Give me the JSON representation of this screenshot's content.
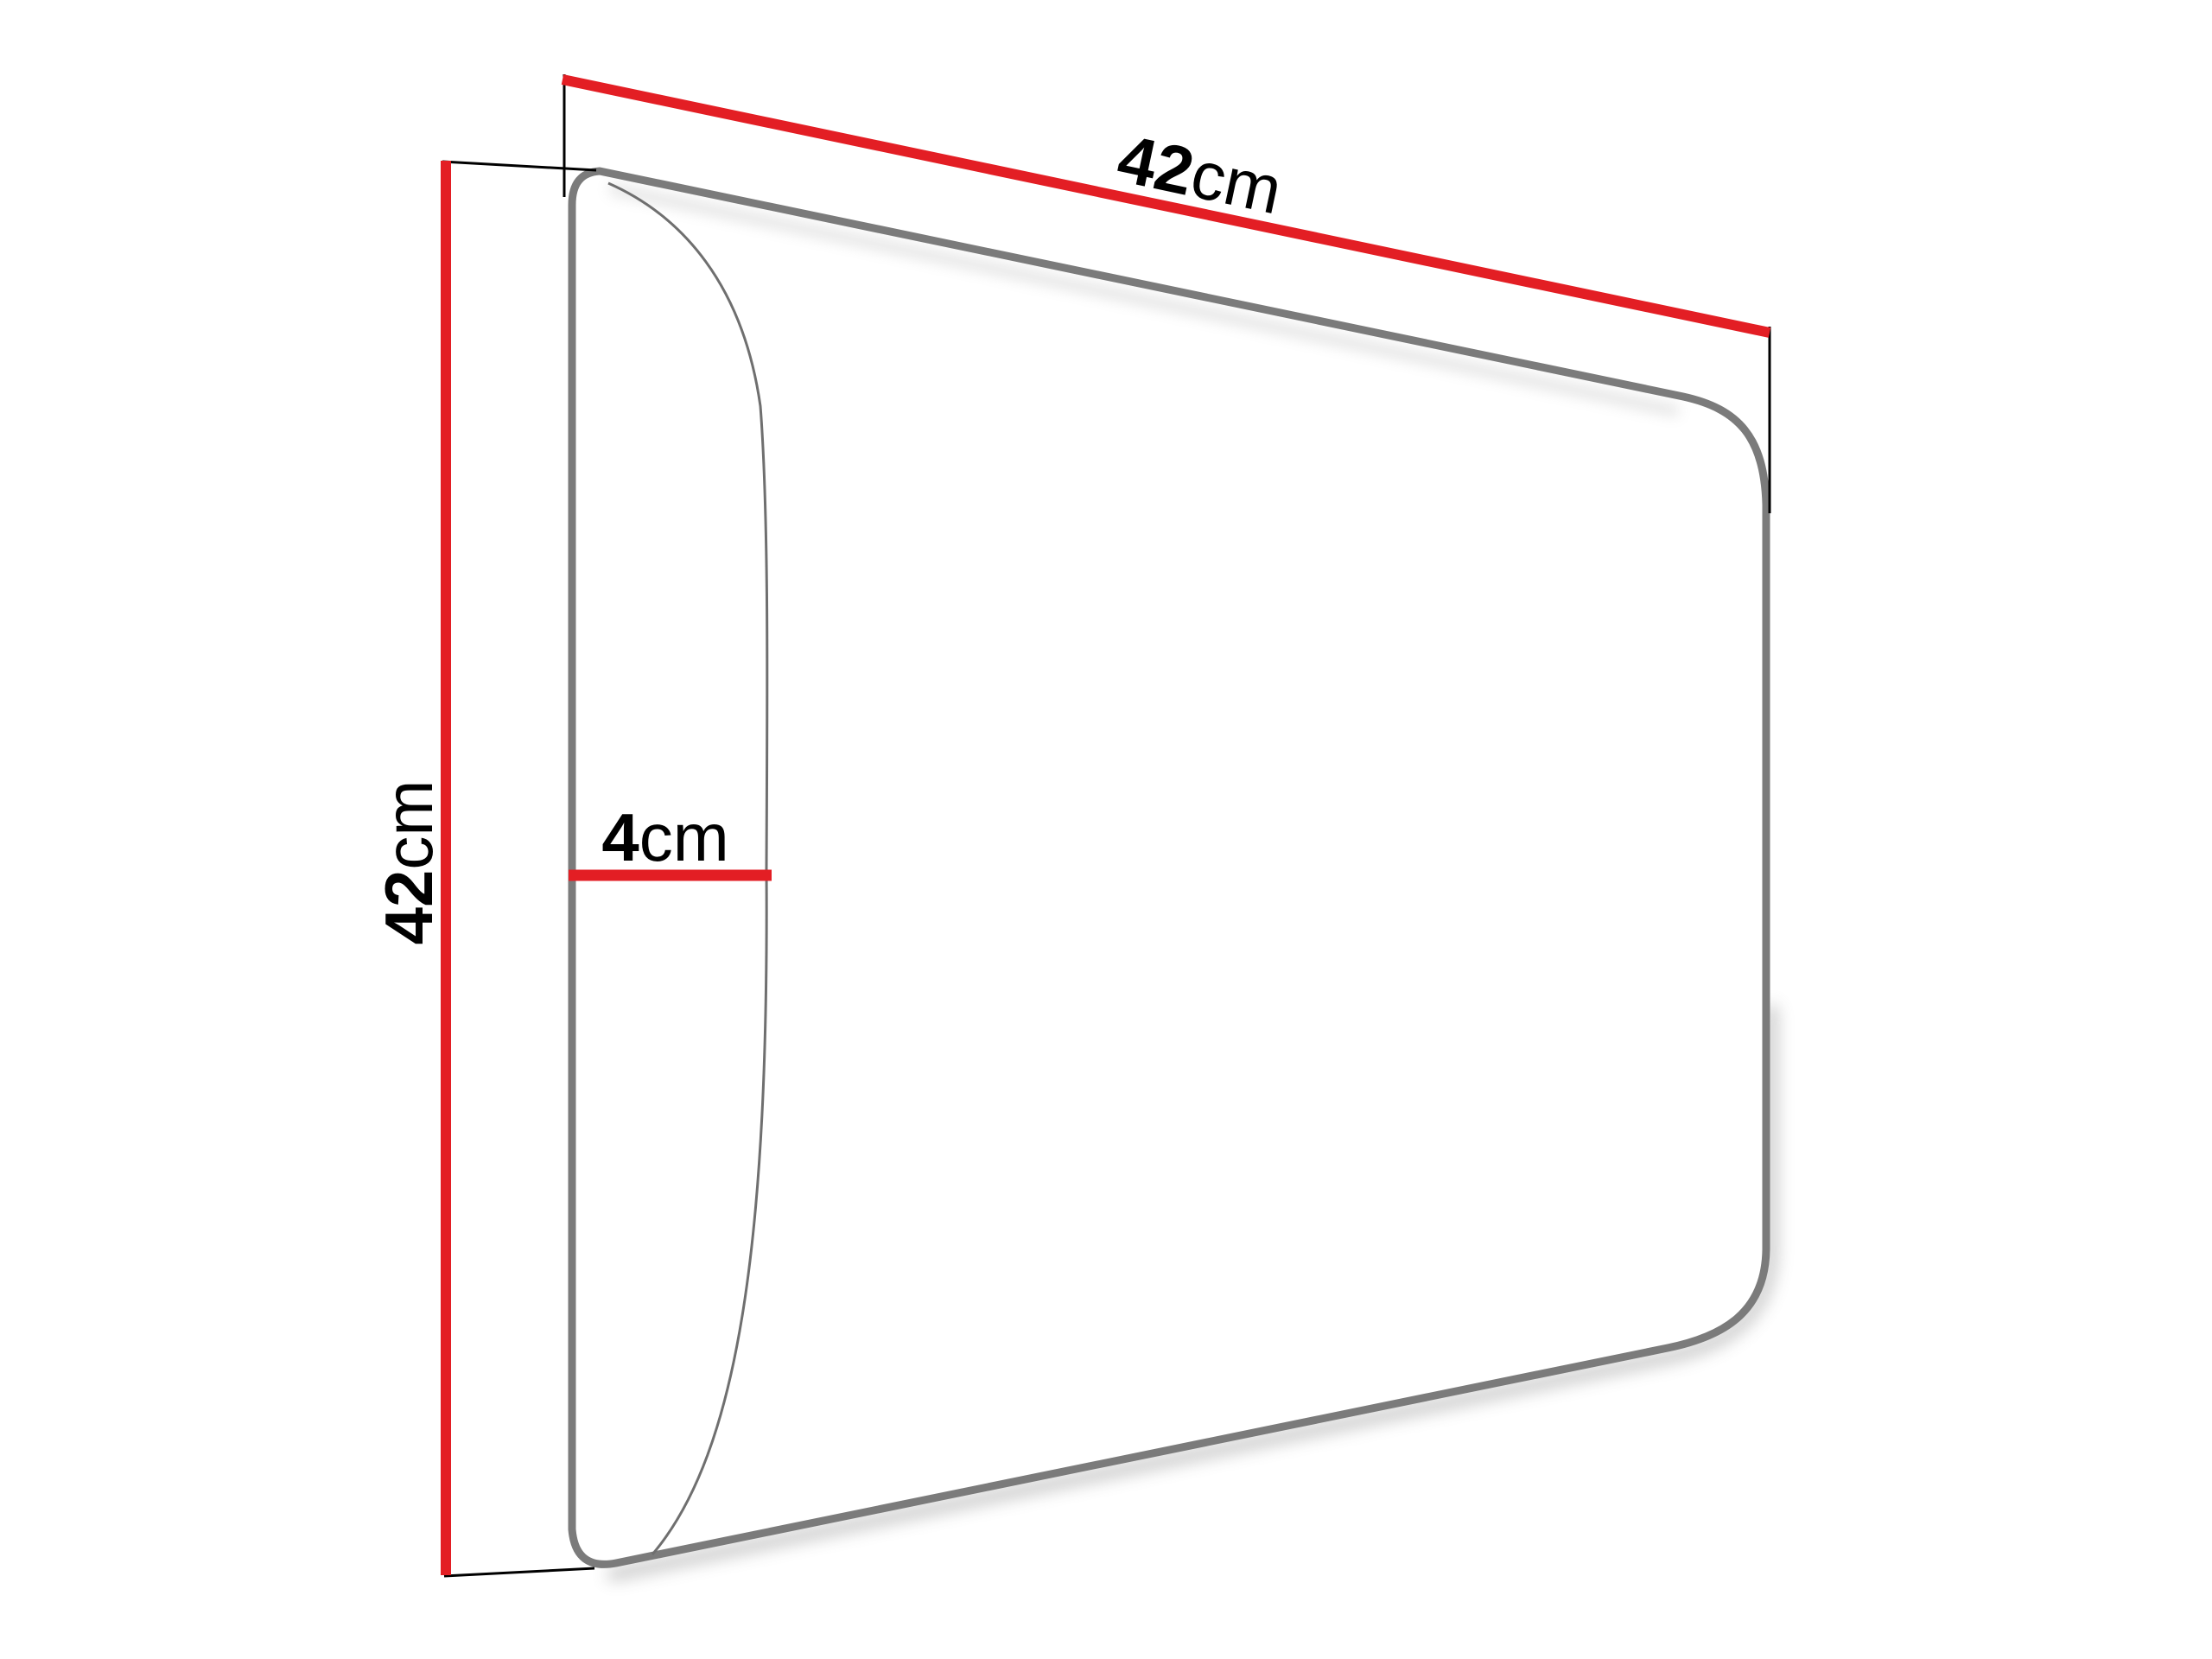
{
  "dimensions": {
    "width": {
      "value": "42",
      "unit": "cm"
    },
    "height": {
      "value": "42",
      "unit": "cm"
    },
    "depth": {
      "value": "4",
      "unit": "cm"
    }
  },
  "colors": {
    "dimension_line": "#e31e24",
    "panel_outline": "#7b7b7b",
    "panel_edge_curve": "#6f6f6f",
    "extension_line": "#000000",
    "label_text": "#000000",
    "shadow": "#8a8a8a",
    "background": "#ffffff"
  }
}
